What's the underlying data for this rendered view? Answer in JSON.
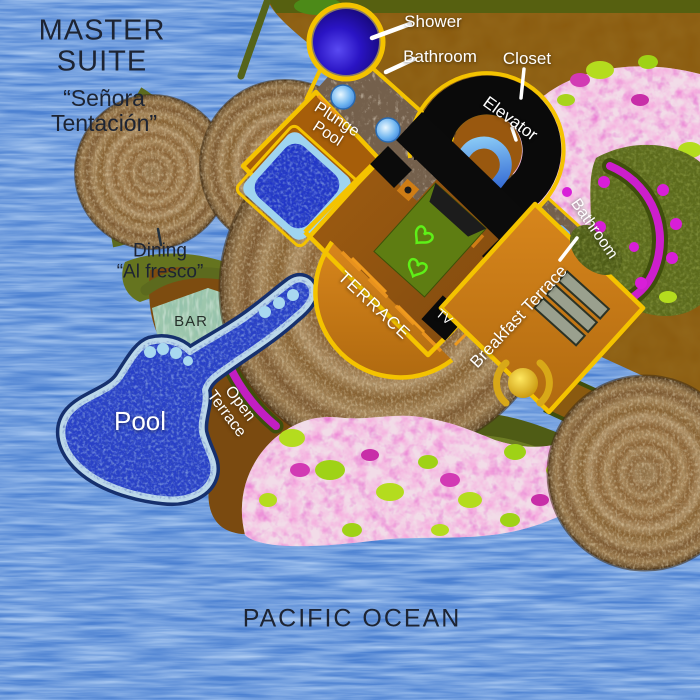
{
  "title": {
    "name": "MASTER\nSUITE",
    "subtitle": "“Señora\nTentación”"
  },
  "ocean": {
    "label": "PACIFIC OCEAN"
  },
  "rooms": {
    "shower": "Shower",
    "bathroom_main": "Bathroom",
    "closet": "Closet",
    "elevator": "Elevator",
    "plunge_pool": "Plunge\nPool",
    "bathroom_guest": "Bathroom",
    "breakfast_terrace": "Breakfast Terrace",
    "terrace": "TERRACE",
    "tv": "TV",
    "open_terrace": "Open\nTerrace",
    "bar": "BAR",
    "pool": "Pool",
    "dining": "Dining\n“Al fresco”"
  },
  "colors": {
    "water": "#4d82d2",
    "land": "#8b5c10",
    "thatch_roof": "#9a7a4e",
    "floor_brown": "#9a5812",
    "terrace_orange": "#c8791a",
    "border_yellow": "#f4c300",
    "pool_blue": "#2840c8",
    "flower_pink": "#f7ebf0",
    "garden_olive": "#5b6a1b",
    "path_magenta": "#cc1ecc",
    "label_light": "#ffffff",
    "label_dark": "#1d2433"
  }
}
